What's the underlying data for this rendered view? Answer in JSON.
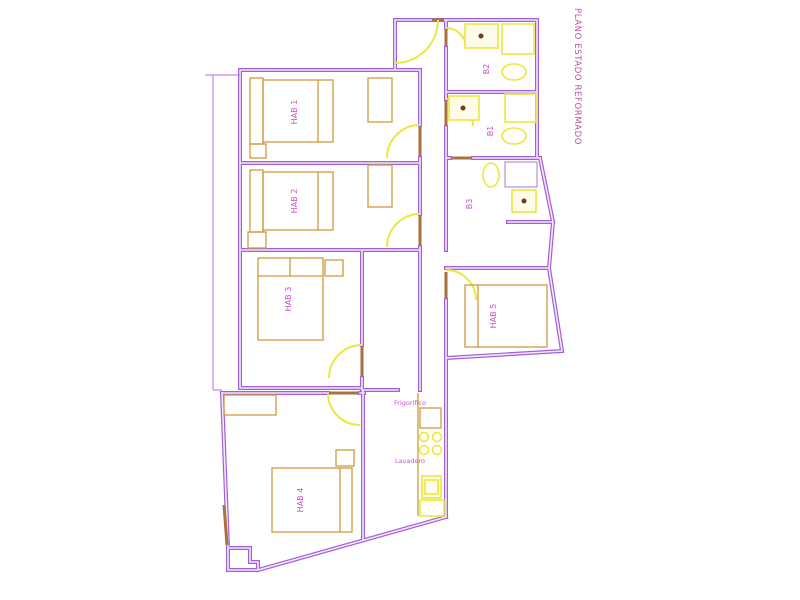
{
  "title": "PLANO ESTADO REFORMADO",
  "labels": {
    "hab1": "HAB 1",
    "hab2": "HAB 2",
    "hab3": "HAB 3",
    "hab4": "HAB 4",
    "hab5": "HAB 5",
    "b1": "B1",
    "b2": "B2",
    "b3": "B3",
    "fridge": "Frigorífico",
    "laundry": "Lavadero"
  },
  "colors": {
    "bg": "#ffffff",
    "wall": "#a45ed6",
    "wall_inner": "#f2e9fb",
    "thin": "#b070dd",
    "fixture": "#ece73c",
    "furniture": "#cf9a3f",
    "jamb": "#a9713c",
    "label": "#c653c6",
    "title": "#b9509c",
    "dot": "#6b3d1f"
  }
}
